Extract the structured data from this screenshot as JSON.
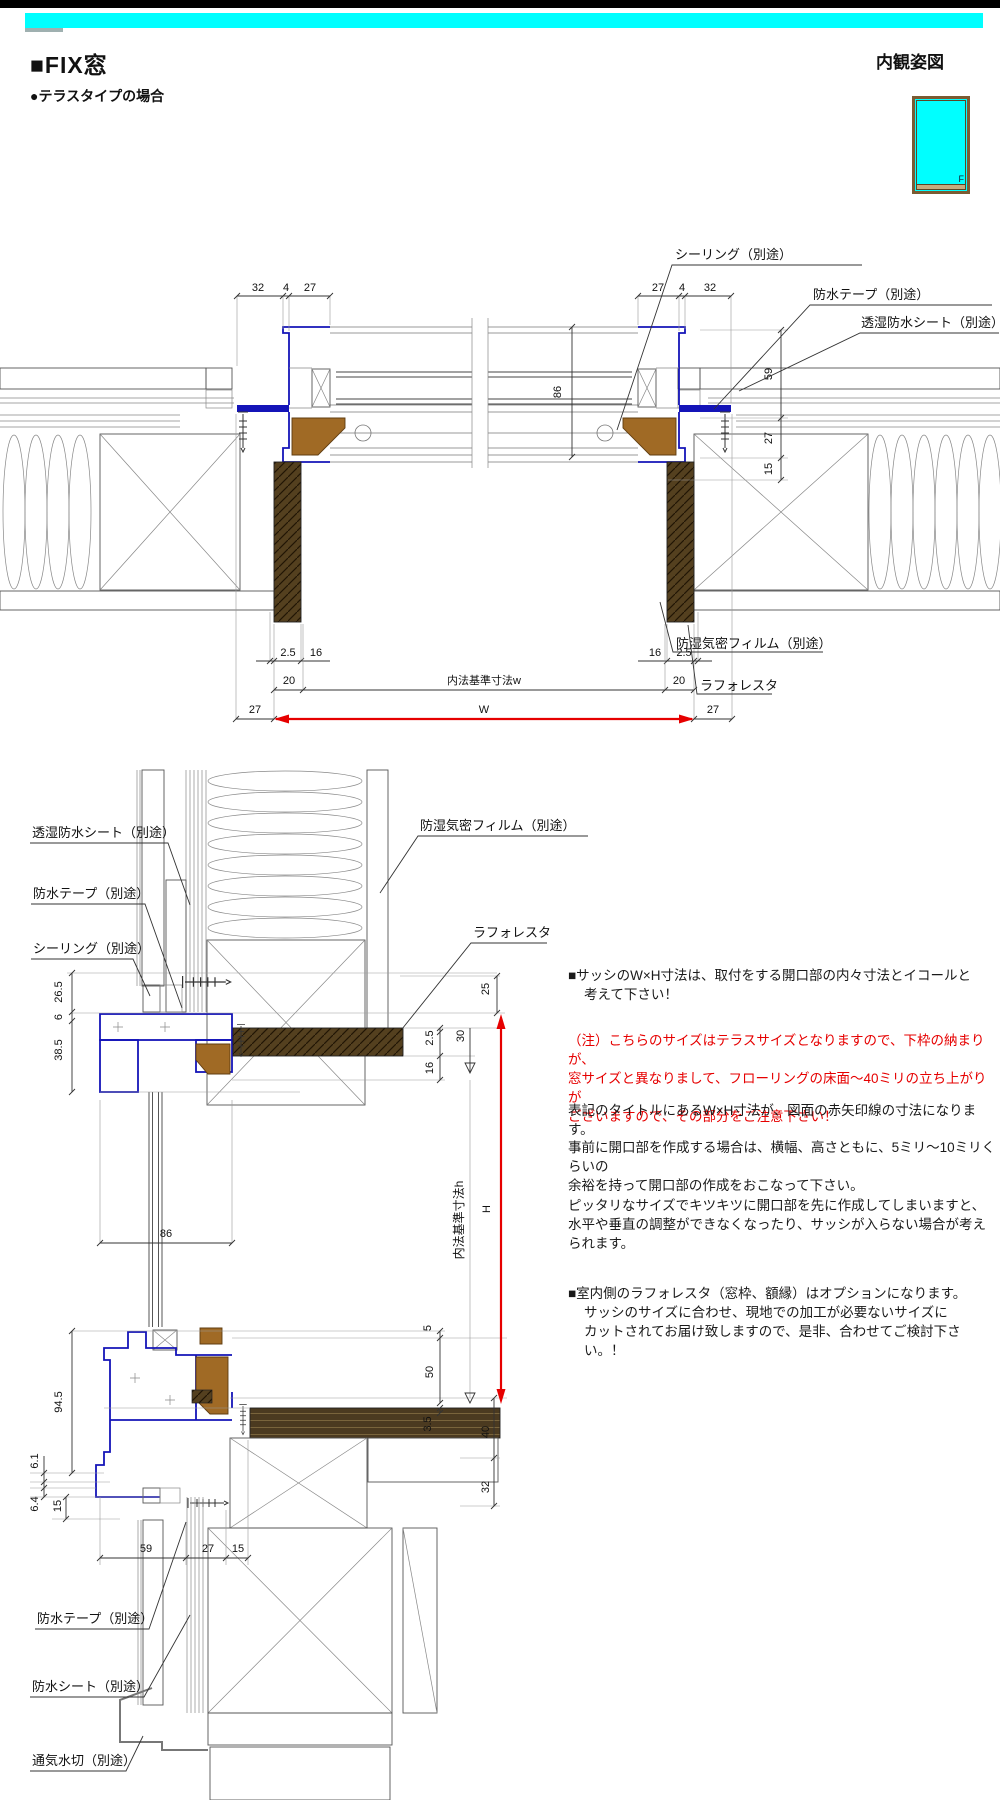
{
  "header": {
    "title": "■FIX窓",
    "subtitle": "●テラスタイプの場合",
    "view_label": "内観姿図",
    "window_icon_letter": "F"
  },
  "colors": {
    "accent_cyan": "#00ffff",
    "frame_blue": "#1414b8",
    "aluminum_brown": "#a06a25",
    "casing_brown": "#54401f",
    "dimension_red": "#e60000",
    "note_red": "#e60000",
    "wood_tan": "#f4e4ca",
    "siding_tan": "#d9cdb4",
    "gypsum_gray": "#dedede"
  },
  "plan": {
    "dims": {
      "tl": [
        "32",
        "4",
        "27"
      ],
      "tr": [
        "27",
        "4",
        "32"
      ],
      "glass": "86",
      "right": [
        "59",
        "27",
        "15"
      ],
      "bl": [
        "2.5",
        "16"
      ],
      "br": [
        "16",
        "2.5"
      ],
      "inner_left": "20",
      "inner_label": "内法基準寸法w",
      "inner_right": "20",
      "w_left": "27",
      "w_label": "W",
      "w_right": "27"
    },
    "callouts": {
      "sealing": "シーリング（別途）",
      "tape": "防水テープ（別途）",
      "sheet": "透湿防水シート（別途）",
      "film": "防湿気密フィルム（別途）",
      "laforesta": "ラフォレスタ"
    }
  },
  "vert": {
    "dims": {
      "head": [
        "26.5",
        "6",
        "38.5"
      ],
      "glass": "86",
      "sill": [
        "94.5",
        "6.1",
        "6.4",
        "15"
      ],
      "bottom": [
        "59",
        "27",
        "15"
      ],
      "right_top": [
        "25",
        "2.5",
        "30",
        "16"
      ],
      "right_bottom": [
        "5",
        "50",
        "3.5",
        "40",
        "32"
      ],
      "inner_label": "内法基準寸法h",
      "h_label": "H"
    },
    "callouts": {
      "sheet": "透湿防水シート（別途）",
      "tape_top": "防水テープ（別途）",
      "sealing": "シーリング（別途）",
      "film": "防湿気密フィルム（別途）",
      "laforesta": "ラフォレスタ",
      "tape_bottom": "防水テープ（別途）",
      "water_sheet": "防水シート（別途）",
      "flashing": "通気水切（別途）"
    }
  },
  "notes": {
    "n1": [
      "■サッシのW×H寸法は、取付をする開口部の内々寸法とイコールと",
      "考えて下さい！"
    ],
    "n2": [
      "（注）こちらのサイズはテラスサイズとなりますので、下枠の納まりが、",
      "窓サイズと異なりまして、フローリングの床面～40ミリの立ち上がりが",
      "ございますので、その部分をご注意下さい！"
    ],
    "n3": [
      "表記のタイトルにあるW×H寸法が、図面の赤矢印線の寸法になります。"
    ],
    "n4": [
      "事前に開口部を作成する場合は、横幅、高さともに、5ミリ～10ミリくらいの",
      "余裕を持って開口部の作成をおこなって下さい。"
    ],
    "n5": [
      "ピッタリなサイズでキツキツに開口部を先に作成してしまいますと、",
      "水平や垂直の調整ができなくなったり、サッシが入らない場合が考え",
      "られます。"
    ],
    "n6": [
      "■室内側のラフォレスタ（窓枠、額縁）はオプションになります。",
      "サッシのサイズに合わせ、現地での加工が必要ないサイズに",
      "カットされてお届け致しますので、是非、合わせてご検討下さい。！"
    ]
  }
}
